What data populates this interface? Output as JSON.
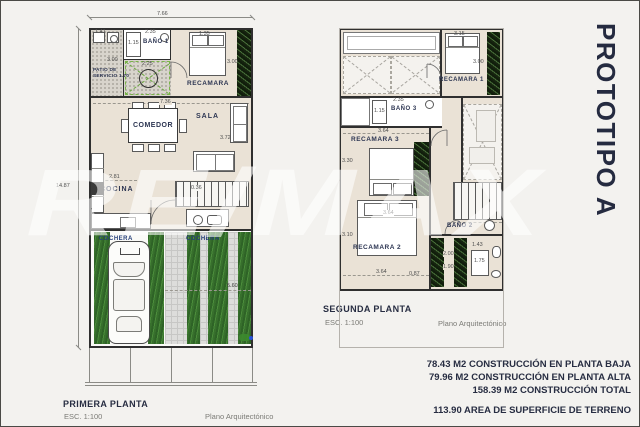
{
  "page": {
    "title": "PROTOTIPO A",
    "watermark": "RE/MAX"
  },
  "summary": {
    "construccion_baja": "78.43 M2 CONSTRUCCIÓN EN PLANTA BAJA",
    "construccion_alta": "79.96 M2 CONSTRUCCIÓN EN PLANTA ALTA",
    "construccion_total": "158.39 M2 CONSTRUCCIÓN TOTAL",
    "superficie_terreno": "113.90 AREA DE SUPERFICIE DE TERRENO"
  },
  "plan1": {
    "title": "PRIMERA PLANTA",
    "scale": "ESC. 1:100",
    "doc_type": "Plano Arquitectónico",
    "rooms": {
      "patio_line1": "PATIO DE",
      "patio_line2": "SERVICIO 1.70",
      "bano1": "BAÑO 1",
      "recamara": "RECAMARA",
      "comedor": "COMEDOR",
      "sala": "SALA",
      "cocina": "COCINA",
      "cochera_izq": "COCHERA",
      "cochera_der": "COCHERA"
    },
    "dims": {
      "lote_frente": "7.66",
      "lote_fondo": "14.87",
      "patio_ancho": "1.41",
      "regadera": "1.15",
      "bano_ancho": "2.35",
      "patio_alto": "3.00",
      "patio_arbol": "2.25",
      "cama": "1.35",
      "recamara_alto": "3.00",
      "interior_ancho": "7.36",
      "sala_alto": "3.72",
      "cocina_ancho": "2.81",
      "escalera": "0.36",
      "cochera_fondo": "5.60"
    }
  },
  "plan2": {
    "title": "SEGUNDA PLANTA",
    "scale": "ESC. 1:100",
    "doc_type": "Plano Arquitectónico",
    "rooms": {
      "recamara1": "RECAMARA 1",
      "bano3": "BAÑO 3",
      "recamara3": "RECAMARA 3",
      "recamara2": "RECAMARA 2",
      "bano2": "BAÑO 2"
    },
    "dims": {
      "cama1": "3.15",
      "recamara1_alto": "3.00",
      "regadera3": "1.15",
      "bano3_ancho": "2.35",
      "recamara3_ancho": "3.64",
      "recamara3_alto": "3.30",
      "recamara2_ancho_sup": "3.64",
      "recamara2_alto": "3.10",
      "recamara2_ancho_inf": "3.64",
      "patio_servicio_inf": "0.87",
      "closet_a": "2.00",
      "closet_b": "1.90",
      "bano2_a": "1.43",
      "bano2_b": "1.75"
    }
  }
}
